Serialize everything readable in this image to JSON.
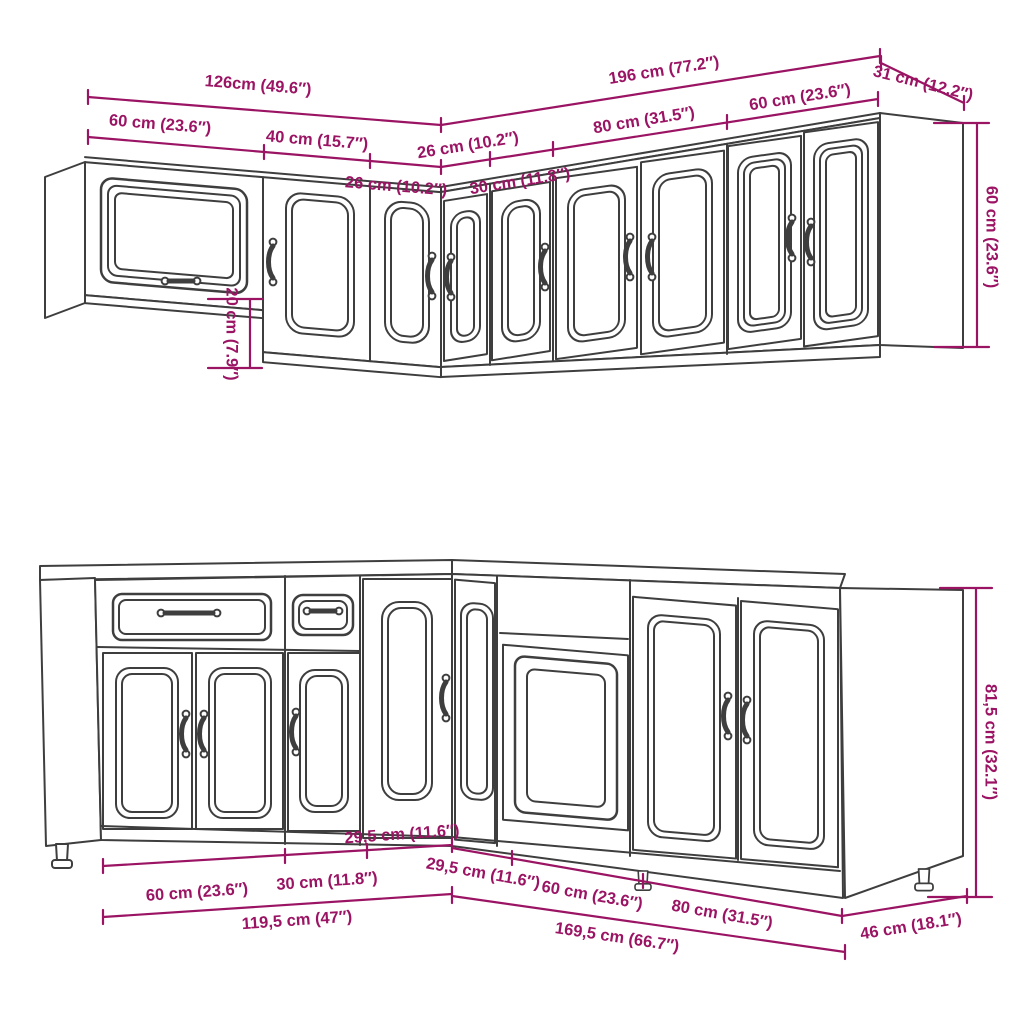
{
  "title": "Kitchen cabinet set dimension diagram",
  "colors": {
    "dimension": "#9b1464",
    "outline": "#3e3e3e",
    "background": "#ffffff"
  },
  "wall_assembly": {
    "description": "Upper wall cabinet L-shaped run",
    "dim_labels": {
      "total_left": "126cm (49.6″)",
      "total_right": "196 cm (77.2″)",
      "side_depth": "31 cm (12.2″)",
      "seg_60_left": "60 cm (23.6″)",
      "seg_40": "40 cm (15.7″)",
      "seg_26_left": "26 cm (10.2″)",
      "seg_26_right": "26 cm (10.2″)",
      "seg_30": "30 cm (11.8″)",
      "seg_80": "80 cm (31.5″)",
      "seg_60_right": "60 cm (23.6″)",
      "height": "60 cm (23.6″)",
      "height_offset": "20 cm (7.9″)"
    }
  },
  "base_assembly": {
    "description": "Base cabinet L-shaped run",
    "dim_labels": {
      "seg_60_left": "60 cm (23.6″)",
      "seg_30": "30 cm (11.8″)",
      "corner_left": "29,5 cm (11.6″)",
      "total_left": "119,5 cm (47″)",
      "corner_right": "29,5 cm (11.6″)",
      "seg_60_right": "60 cm (23.6″)",
      "seg_80": "80 cm (31.5″)",
      "total_right": "169,5 cm (66.7″)",
      "side_depth": "46 cm (18.1″)",
      "height": "81,5 cm (32.1″)"
    }
  }
}
